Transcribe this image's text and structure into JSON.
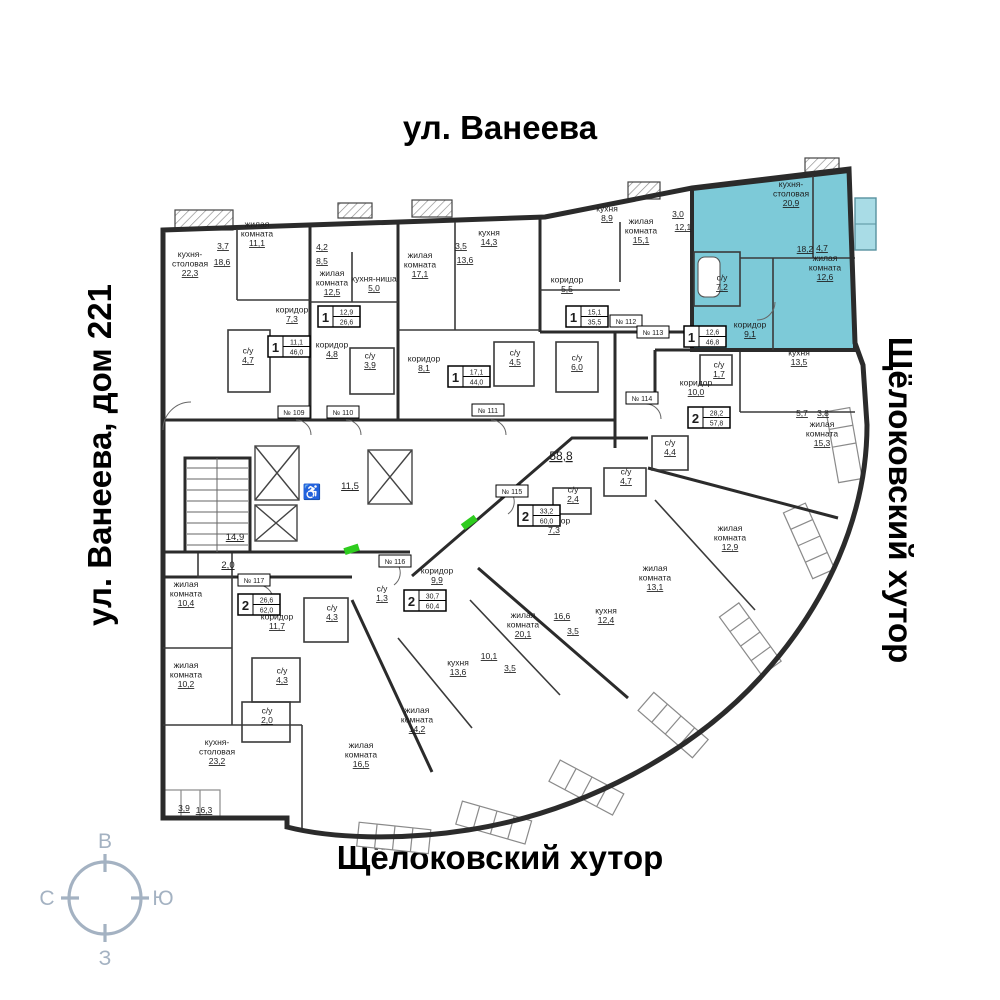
{
  "streets": {
    "top": "ул. Ванеева",
    "left": "ул. Ванеева, дом 221",
    "right": "Щёлоковский хутор",
    "bottom": "Щёлоковский хутор"
  },
  "compass": {
    "top": "В",
    "right": "Ю",
    "bottom": "З",
    "left": "С",
    "color": "#a4b2c2"
  },
  "highlight": {
    "color": "#7dcad8",
    "unit_plate": "№ 113",
    "rooms": "1",
    "living_area": "12,6",
    "total_area": "46,8"
  },
  "plan": {
    "labels": [
      {
        "x": 223,
        "y": 249,
        "a": "3,7"
      },
      {
        "x": 222,
        "y": 265,
        "a": "18,6"
      },
      {
        "x": 190,
        "y": 266,
        "l": [
          "кухня-",
          "столовая"
        ],
        "a": "22,3"
      },
      {
        "x": 257,
        "y": 236,
        "l": [
          "жилая",
          "комната"
        ],
        "a": "11,1"
      },
      {
        "x": 292,
        "y": 317,
        "l": [
          "коридор"
        ],
        "a": "7,3"
      },
      {
        "x": 248,
        "y": 358,
        "l": [
          "с/у"
        ],
        "a": "4,7"
      },
      {
        "x": 322,
        "y": 250,
        "a": "4,2"
      },
      {
        "x": 322,
        "y": 264,
        "a": "8,5"
      },
      {
        "x": 332,
        "y": 285,
        "l": [
          "жилая",
          "комната"
        ],
        "a": "12,5"
      },
      {
        "x": 374,
        "y": 286,
        "l": [
          "кухня-ниша"
        ],
        "a": "5,0"
      },
      {
        "x": 332,
        "y": 352,
        "l": [
          "коридор"
        ],
        "a": "4,8"
      },
      {
        "x": 370,
        "y": 363,
        "l": [
          "с/у"
        ],
        "a": "3,9"
      },
      {
        "x": 420,
        "y": 267,
        "l": [
          "жилая",
          "комната"
        ],
        "a": "17,1"
      },
      {
        "x": 461,
        "y": 249,
        "a": "3,5"
      },
      {
        "x": 465,
        "y": 263,
        "a": "13,6"
      },
      {
        "x": 489,
        "y": 240,
        "l": [
          "кухня"
        ],
        "a": "14,3"
      },
      {
        "x": 424,
        "y": 366,
        "l": [
          "коридор"
        ],
        "a": "8,1"
      },
      {
        "x": 515,
        "y": 360,
        "l": [
          "с/у"
        ],
        "a": "4,5"
      },
      {
        "x": 607,
        "y": 216,
        "l": [
          "кухня"
        ],
        "a": "8,9"
      },
      {
        "x": 641,
        "y": 233,
        "l": [
          "жилая",
          "комната"
        ],
        "a": "15,1"
      },
      {
        "x": 678,
        "y": 217,
        "a": "3,0"
      },
      {
        "x": 683,
        "y": 230,
        "a": "12,1"
      },
      {
        "x": 567,
        "y": 287,
        "l": [
          "коридор"
        ],
        "a": "5,5"
      },
      {
        "x": 577,
        "y": 365,
        "l": [
          "с/у"
        ],
        "a": "6,0"
      },
      {
        "x": 791,
        "y": 196,
        "l": [
          "кухня-",
          "столовая"
        ],
        "a": "20,9"
      },
      {
        "x": 805,
        "y": 252,
        "a": "18,2"
      },
      {
        "x": 822,
        "y": 251,
        "a": "4,7"
      },
      {
        "x": 825,
        "y": 270,
        "l": [
          "жилая",
          "комната"
        ],
        "a": "12,6"
      },
      {
        "x": 722,
        "y": 285,
        "l": [
          "с/у"
        ],
        "a": "7,2"
      },
      {
        "x": 750,
        "y": 332,
        "l": [
          "коридор"
        ],
        "a": "9,1"
      },
      {
        "x": 799,
        "y": 360,
        "l": [
          "кухня"
        ],
        "a": "13,5"
      },
      {
        "x": 719,
        "y": 372,
        "l": [
          "с/у"
        ],
        "a": "1,7"
      },
      {
        "x": 696,
        "y": 390,
        "l": [
          "коридор"
        ],
        "a": "10,0"
      },
      {
        "x": 802,
        "y": 416,
        "a": "5,7"
      },
      {
        "x": 823,
        "y": 416,
        "a": "3,8"
      },
      {
        "x": 822,
        "y": 436,
        "l": [
          "жилая",
          "комната"
        ],
        "a": "15,3"
      },
      {
        "x": 670,
        "y": 450,
        "l": [
          "с/у"
        ],
        "a": "4,4"
      },
      {
        "x": 573,
        "y": 497,
        "l": [
          "с/у"
        ],
        "a": "2,4"
      },
      {
        "x": 626,
        "y": 479,
        "l": [
          "с/у"
        ],
        "a": "4,7"
      },
      {
        "x": 554,
        "y": 528,
        "l": [
          "коридор"
        ],
        "a": "7,3"
      },
      {
        "x": 655,
        "y": 580,
        "l": [
          "жилая",
          "комната"
        ],
        "a": "13,1"
      },
      {
        "x": 730,
        "y": 540,
        "l": [
          "жилая",
          "комната"
        ],
        "a": "12,9"
      },
      {
        "x": 606,
        "y": 618,
        "l": [
          "кухня"
        ],
        "a": "12,4"
      },
      {
        "x": 562,
        "y": 619,
        "a": "16,6"
      },
      {
        "x": 573,
        "y": 634,
        "a": "3,5"
      },
      {
        "x": 437,
        "y": 578,
        "l": [
          "коридор"
        ],
        "a": "9,9"
      },
      {
        "x": 382,
        "y": 596,
        "l": [
          "с/у"
        ],
        "a": "1,3"
      },
      {
        "x": 523,
        "y": 627,
        "l": [
          "жилая",
          "комната"
        ],
        "a": "20,1"
      },
      {
        "x": 489,
        "y": 659,
        "a": "10,1"
      },
      {
        "x": 510,
        "y": 671,
        "a": "3,5"
      },
      {
        "x": 458,
        "y": 670,
        "l": [
          "кухня"
        ],
        "a": "13,6"
      },
      {
        "x": 417,
        "y": 722,
        "l": [
          "жилая",
          "комната"
        ],
        "a": "14,2"
      },
      {
        "x": 186,
        "y": 596,
        "l": [
          "жилая",
          "комната"
        ],
        "a": "10,4"
      },
      {
        "x": 186,
        "y": 677,
        "l": [
          "жилая",
          "комната"
        ],
        "a": "10,2"
      },
      {
        "x": 277,
        "y": 624,
        "l": [
          "коридор"
        ],
        "a": "11,7"
      },
      {
        "x": 332,
        "y": 615,
        "l": [
          "с/у"
        ],
        "a": "4,3"
      },
      {
        "x": 282,
        "y": 678,
        "l": [
          "с/у"
        ],
        "a": "4,3"
      },
      {
        "x": 267,
        "y": 718,
        "l": [
          "с/у"
        ],
        "a": "2,0"
      },
      {
        "x": 217,
        "y": 754,
        "l": [
          "кухня-",
          "столовая"
        ],
        "a": "23,2"
      },
      {
        "x": 361,
        "y": 757,
        "l": [
          "жилая",
          "комната"
        ],
        "a": "16,5"
      },
      {
        "x": 184,
        "y": 811,
        "a": "3,9"
      },
      {
        "x": 204,
        "y": 813,
        "a": "16,3"
      },
      {
        "x": 235,
        "y": 540,
        "a": "14,9",
        "s": "mid"
      },
      {
        "x": 228,
        "y": 568,
        "a": "2,0",
        "s": "mid"
      },
      {
        "x": 350,
        "y": 489,
        "a": "11,5",
        "s": "mid"
      },
      {
        "x": 561,
        "y": 460,
        "a": "58,8",
        "s": "big"
      }
    ],
    "badges": [
      {
        "x": 268,
        "y": 336,
        "rooms": "1",
        "living": "11,1",
        "total": "46,0"
      },
      {
        "x": 318,
        "y": 306,
        "rooms": "1",
        "living": "12,9",
        "total": "26,6"
      },
      {
        "x": 448,
        "y": 366,
        "rooms": "1",
        "living": "17,1",
        "total": "44,0"
      },
      {
        "x": 566,
        "y": 306,
        "rooms": "1",
        "living": "15,1",
        "total": "35,5"
      },
      {
        "x": 684,
        "y": 326,
        "rooms": "1",
        "living": "12,6",
        "total": "46,8"
      },
      {
        "x": 688,
        "y": 407,
        "rooms": "2",
        "living": "28,2",
        "total": "57,8"
      },
      {
        "x": 518,
        "y": 505,
        "rooms": "2",
        "living": "33,2",
        "total": "60,0"
      },
      {
        "x": 404,
        "y": 590,
        "rooms": "2",
        "living": "30,7",
        "total": "60,4"
      },
      {
        "x": 238,
        "y": 594,
        "rooms": "2",
        "living": "26,6",
        "total": "62,0"
      }
    ],
    "unit_plates": [
      {
        "x": 294,
        "y": 412,
        "label": "№ 109"
      },
      {
        "x": 343,
        "y": 412,
        "label": "№ 110"
      },
      {
        "x": 488,
        "y": 410,
        "label": "№ 111"
      },
      {
        "x": 626,
        "y": 321,
        "label": "№ 112"
      },
      {
        "x": 653,
        "y": 332,
        "label": "№ 113"
      },
      {
        "x": 642,
        "y": 398,
        "label": "№ 114"
      },
      {
        "x": 512,
        "y": 491,
        "label": "№ 115"
      },
      {
        "x": 395,
        "y": 561,
        "label": "№ 116"
      },
      {
        "x": 254,
        "y": 580,
        "label": "№ 117"
      }
    ],
    "wheelchair_icon": "♿",
    "door_marker_color": "#2ecc1e"
  }
}
